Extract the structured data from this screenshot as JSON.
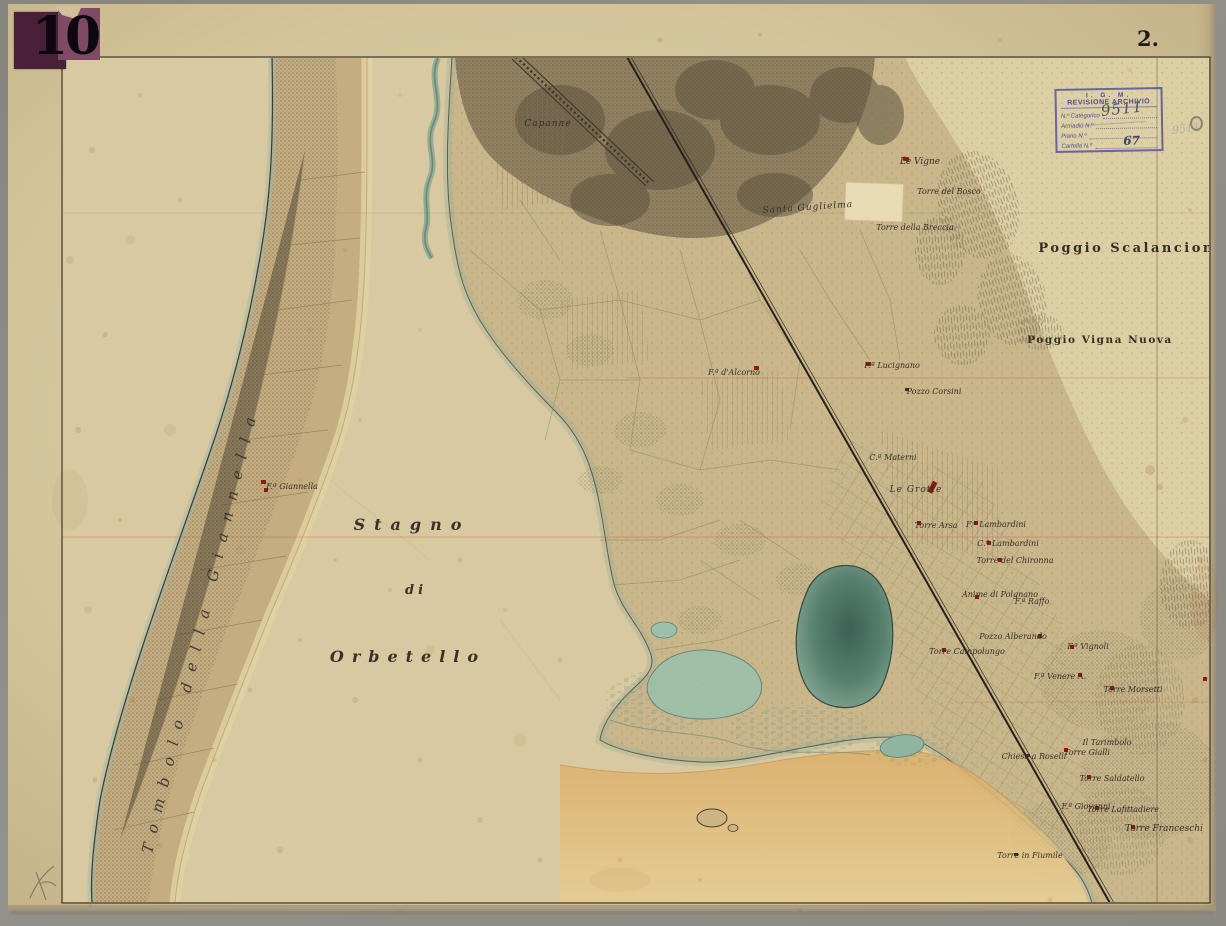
{
  "sheet": {
    "corner_number": "10",
    "page_number": "2."
  },
  "stamp": {
    "org": "I. G. M.",
    "title": "REVISIONE ARCHIVIO",
    "fields": [
      {
        "label": "N.º Categorico",
        "value": "9511"
      },
      {
        "label": "Armadio  N.º",
        "value": ""
      },
      {
        "label": "Piano  N.º",
        "value": ""
      },
      {
        "label": "Cartella  N.º",
        "value": "67"
      }
    ]
  },
  "map": {
    "lagoon_label": {
      "line1": "Stagno",
      "line2": "di",
      "line3": "Orbetello"
    },
    "tombolo_label": "Tombolo della Giannella",
    "places": [
      {
        "text": "Capanne"
      },
      {
        "text": "Santa Guglielma"
      },
      {
        "text": "Le Vigne"
      },
      {
        "text": "Torre del Bosco"
      },
      {
        "text": "Torre della Breccia"
      },
      {
        "text": "Poggio Scalancione"
      },
      {
        "text": "Poggio Vigna Nuova"
      },
      {
        "text": "F.ª Lucignano"
      },
      {
        "text": "Pozzo Corsini"
      },
      {
        "text": "F.ª d'Alcorno"
      },
      {
        "text": "C.ª Materni"
      },
      {
        "text": "Le Grotte"
      },
      {
        "text": "Torre Arsa"
      },
      {
        "text": "F.ª Lambardini"
      },
      {
        "text": "C.ª Lambardini"
      },
      {
        "text": "Torre del Chironna"
      },
      {
        "text": "Anime di Polgnano"
      },
      {
        "text": "F.ª Raffo"
      },
      {
        "text": "Pozzo Alberando"
      },
      {
        "text": "Torre Campolungo"
      },
      {
        "text": "F.ª Vignoli"
      },
      {
        "text": "F.ª Venere A."
      },
      {
        "text": "Torre Morsetti"
      },
      {
        "text": "Il Tarimbolo"
      },
      {
        "text": "Torre Gialli"
      },
      {
        "text": "Chiesa a Roselli"
      },
      {
        "text": "Torre Saldatello"
      },
      {
        "text": "F.ª Giovanni"
      },
      {
        "text": "Torre Lafittadiere"
      },
      {
        "text": "Torre Franceschi"
      },
      {
        "text": "Torre in Fiumile"
      },
      {
        "text": "F.ª Giannella"
      }
    ]
  },
  "colors": {
    "paper": "#d6c79e",
    "ink": "#332c22",
    "stamp_ink": "#4a4a9e",
    "building_red": "#8b1a12",
    "water": "#57806f",
    "sand": "#d9b071",
    "badge_purple": "#482038"
  }
}
